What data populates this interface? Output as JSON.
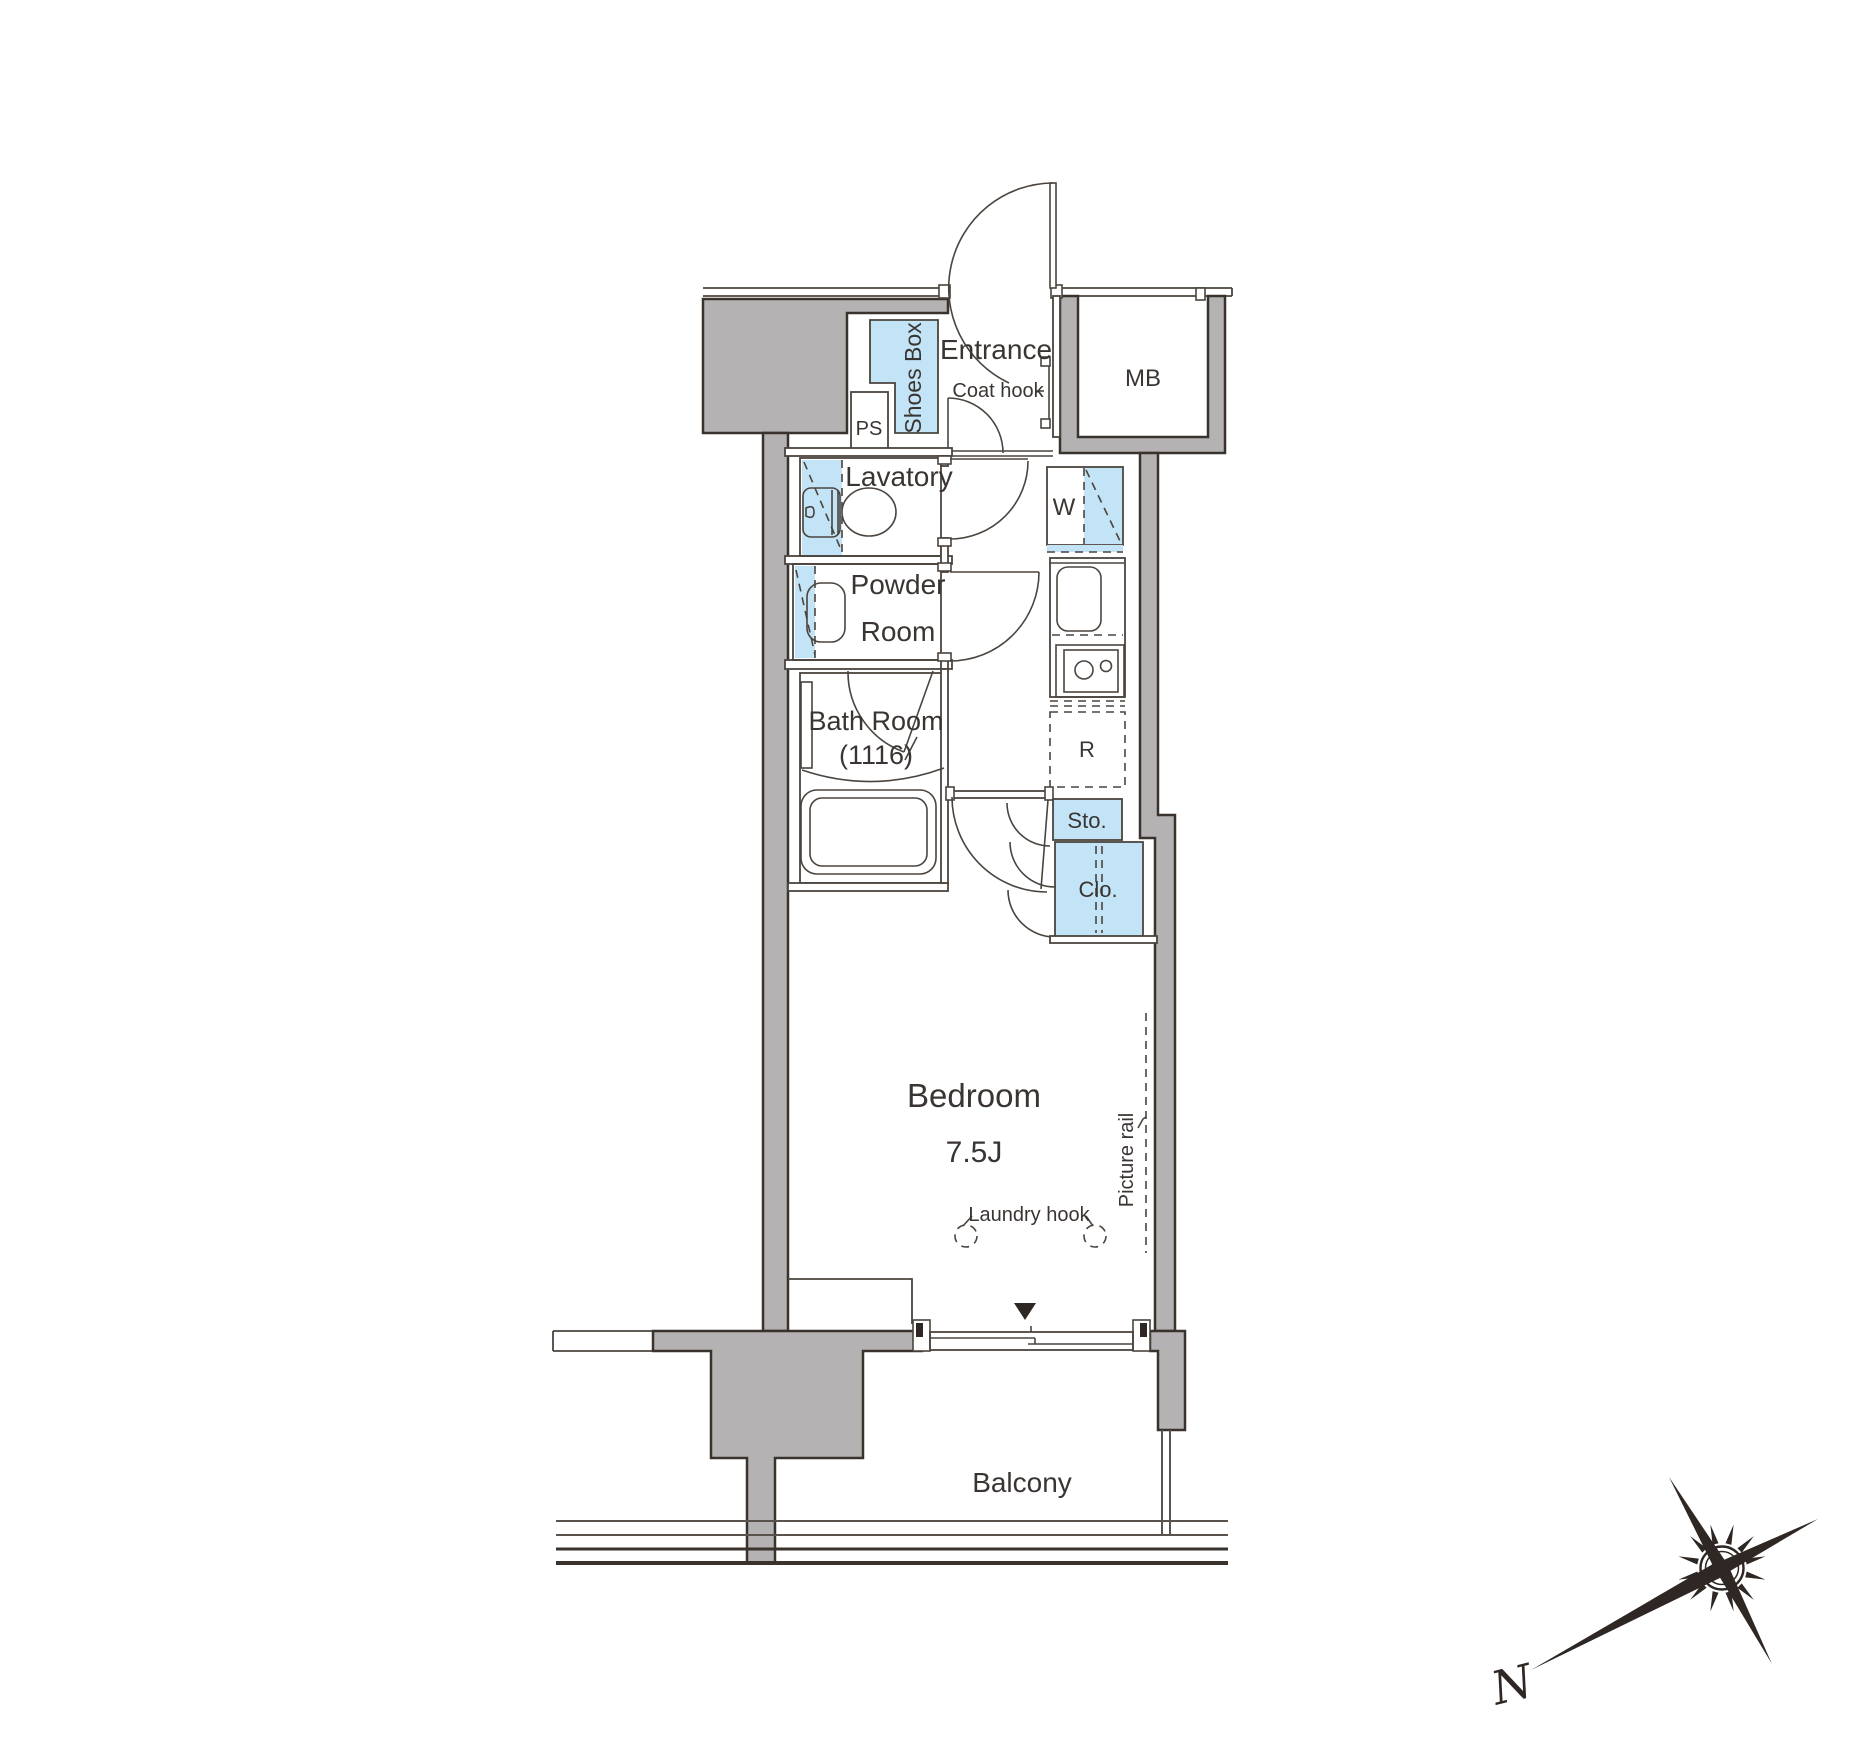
{
  "title": "Apartment floor plan 1K 7.5J",
  "labels": {
    "entrance": "Entrance",
    "coat_hook": "Coat hook",
    "meter_box": "MB",
    "shoes_box": "Shoes Box",
    "pipe_space": "PS",
    "lavatory": "Lavatory",
    "washer": "W",
    "powder_line1": "Powder",
    "powder_line2": "Room",
    "bath_line1": "Bath Room",
    "bath_line2": "(1116)",
    "refrigerator": "R",
    "storage": "Sto.",
    "closet": "Clo.",
    "bedroom": "Bedroom",
    "bedroom_size": "7.5J",
    "laundry_hook": "Laundry hook",
    "picture_rail": "Picture rail",
    "balcony": "Balcony",
    "north": "N"
  },
  "colors": {
    "wall_fill": "#b4b2b2",
    "highlight_fill": "#c2e4f6",
    "line": "#3a332e",
    "text": "#3a3532",
    "background": "#ffffff"
  }
}
